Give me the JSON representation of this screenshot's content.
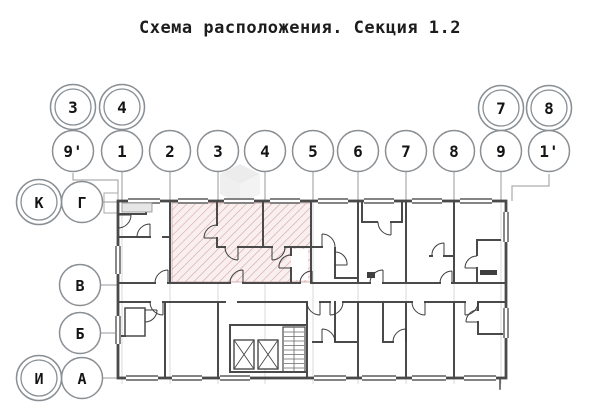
{
  "page": {
    "title": "Схема расположения. Секция 1.2"
  },
  "colors": {
    "highlight_fill": "#f9efef",
    "highlight_hatch": "#d2a2a2",
    "wall": "#4a4a4a",
    "axis_line": "#c4c8cd",
    "circle_stroke": "#8a8f94"
  },
  "axes": {
    "columns": [
      "9'",
      "1",
      "2",
      "3",
      "4",
      "5",
      "6",
      "7",
      "8",
      "9",
      "1'"
    ],
    "columns_secondary": [
      "3",
      "4",
      "7",
      "8"
    ],
    "rows": [
      "Г",
      "В",
      "Б",
      "А"
    ],
    "rows_secondary": [
      "К",
      "И"
    ]
  }
}
